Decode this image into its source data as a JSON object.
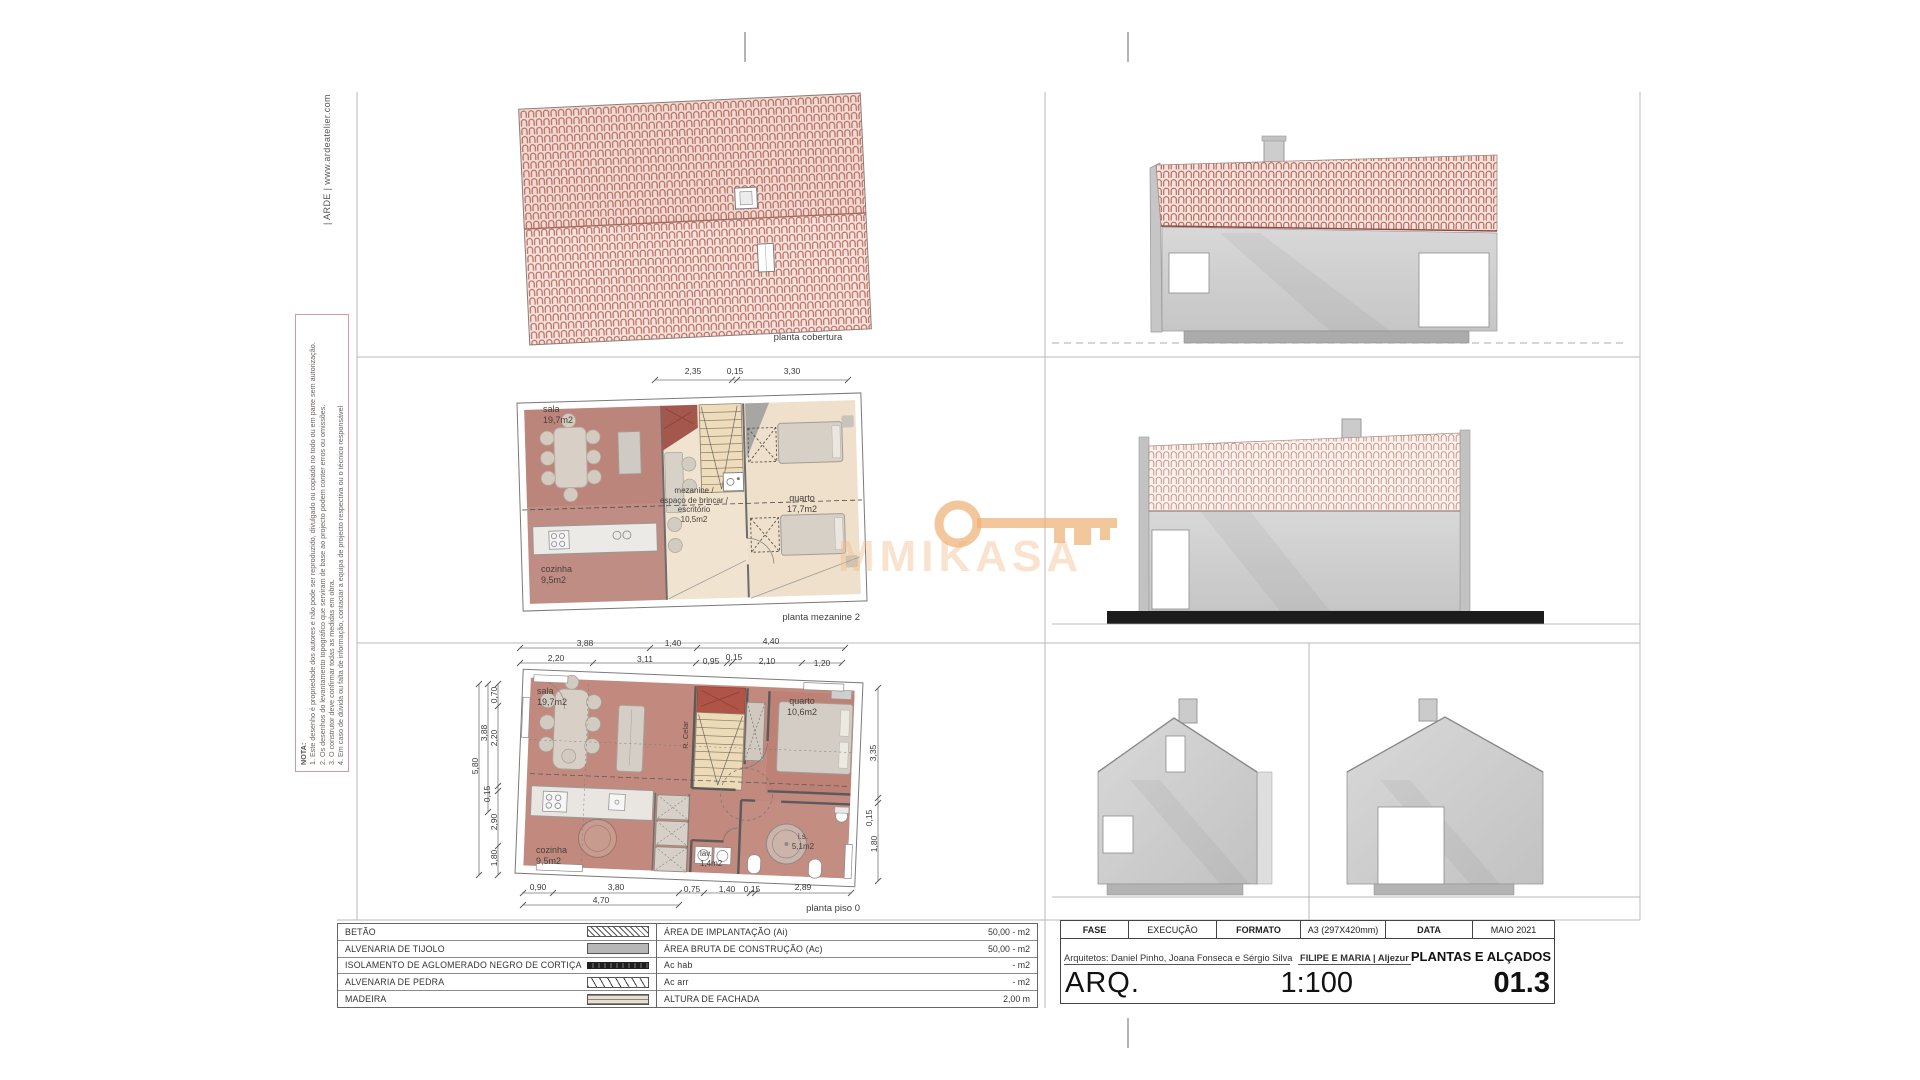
{
  "sheet": {
    "brand": "| ARDE | www.ardeatelier.com",
    "watermark": "MMIKASA"
  },
  "nota": {
    "title": "NOTA:",
    "line1": "1. Este desenho é propriedade dos autores e não pode ser reproduzido, divulgado ou copiado no todo ou em parte sem autorização.",
    "line2": "2. Os desenhos do levantamento topográfico que serviram de base ao projecto podem conter erros ou omissões.",
    "line3": "3. O construtor deve confirmar todas as medidas em obra.",
    "line4": "4. Em caso de dúvida ou falta de informação, contactar a equipa de projecto respectiva ou o técnico responsável"
  },
  "roof_plan": {
    "caption": "planta cobertura"
  },
  "mezzanine_plan": {
    "caption": "planta mezanine 2",
    "dims_top": [
      "2,35",
      "0,15",
      "3,30"
    ],
    "room_sala": "sala\n19,7m2",
    "room_mezzanine": "mezanine /\nespaço de brincar /\nescritório\n10,5m2",
    "room_quarto": "quarto\n17,7m2",
    "room_cozinha": "cozinha\n9,5m2"
  },
  "floor_plan": {
    "caption": "planta piso 0",
    "room_sala": "sala\n19,7m2",
    "room_quarto": "quarto\n10,6m2",
    "room_cozinha": "cozinha\n9,5m2",
    "room_lav": "lav.\n1,4m2",
    "room_is": "i.s.\n5,1m2",
    "room_storage": "R. Celar",
    "dims_top": [
      "3,88",
      "1,40",
      "4,40"
    ],
    "dims_top2": [
      "2,20",
      "3,11",
      "0,95",
      "0,15",
      "2,10",
      "1,20"
    ],
    "dims_left": [
      "0,70",
      "2,20",
      "0,15",
      "2,90",
      "1,80"
    ],
    "dims_left_outer": [
      "3,88",
      "5,80"
    ],
    "dims_right": [
      "3,35",
      "0,15",
      "1,80"
    ],
    "dims_bottom": [
      "0,90",
      "3,80",
      "0,75",
      "1,40",
      "0,15",
      "2,89"
    ],
    "dim_bottom_total": "4,70"
  },
  "legend": {
    "materials": [
      {
        "label": "BETÃO",
        "swatch": "diagonal-hatch-fine"
      },
      {
        "label": "ALVENARIA DE TIJOLO",
        "swatch": "solid-gray"
      },
      {
        "label": "ISOLAMENTO DE AGLOMERADO NEGRO DE CORTIÇA",
        "swatch": "dark-bar"
      },
      {
        "label": "ALVENARIA DE PEDRA",
        "swatch": "diagonal-hatch-coarse"
      },
      {
        "label": "MADEIRA",
        "swatch": "wood-grain"
      }
    ],
    "areas": [
      {
        "label": "ÁREA DE IMPLANTAÇÃO (Ai)",
        "value": "50,00 - m2"
      },
      {
        "label": "ÁREA BRUTA DE CONSTRUÇÃO (Ac)",
        "value": "50,00 - m2"
      },
      {
        "label": "Ac hab",
        "value": "- m2"
      },
      {
        "label": "Ac arr",
        "value": "- m2"
      },
      {
        "label": "ALTURA DE FACHADA",
        "value": "2,00 m"
      }
    ]
  },
  "title_block": {
    "fase_label": "FASE",
    "fase_value": "EXECUÇÃO",
    "formato_label": "FORMATO",
    "formato_value": "A3 (297X420mm)",
    "data_label": "DATA",
    "data_value": "MAIO 2021",
    "architects": "Arquitetos: Daniel Pinho, Joana Fonseca e Sérgio Silva",
    "client": "FILIPE E MARIA | Aljezur",
    "sheet_title": "PLANTAS E ALÇADOS",
    "discipline": "ARQ.",
    "scale": "1:100",
    "sheet_number": "01.3"
  },
  "colors": {
    "tile_red": "#bb6256",
    "plan_rose": "#c28a7f",
    "wood": "#f0e3cf",
    "stair": "#eddbb7",
    "landing_red": "#b05448",
    "elevation_wall": "#d0d0d0",
    "base_black": "#1c1c1c",
    "watermark_orange": "#eeb276",
    "nota_border": "#d49a9a"
  }
}
